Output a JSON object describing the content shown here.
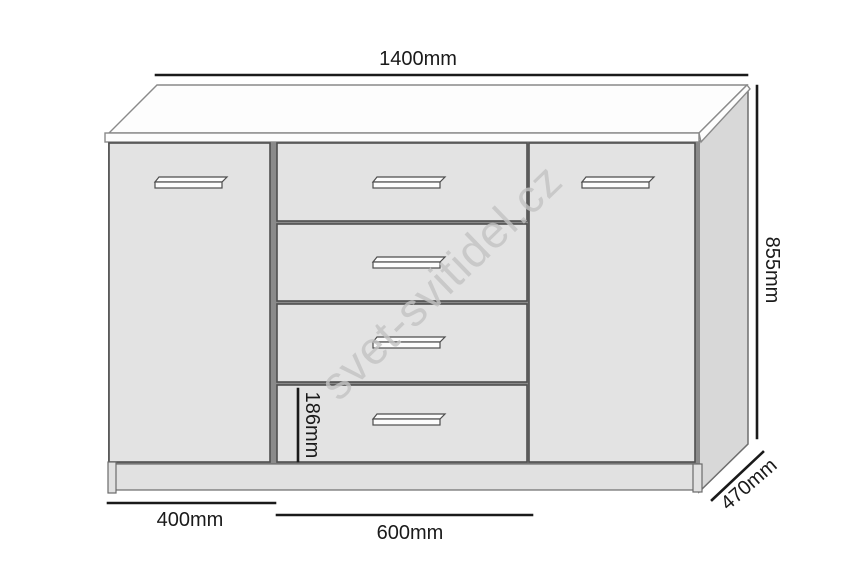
{
  "diagram": {
    "watermark": "svet-svitidel.cz",
    "furniture": {
      "doors": 2,
      "drawers": 4
    },
    "labels": {
      "overall_width": "1400mm",
      "overall_height": "855mm",
      "depth": "470mm",
      "door_width": "400mm",
      "drawer_width": "600mm",
      "drawer_front_height": "186mm"
    },
    "colors": {
      "dimension_line": "#1a1a1a",
      "dimension_text": "#1a1a1a",
      "panel_fill": "#e3e3e3",
      "side_panel_fill": "#d8d8d8",
      "top_fill": "#fdfdfd",
      "gap_fill": "#8a8a8a",
      "plinth_fill": "#e1e1e1",
      "watermark_gray": "#c3c3c3",
      "background": "#ffffff"
    }
  }
}
